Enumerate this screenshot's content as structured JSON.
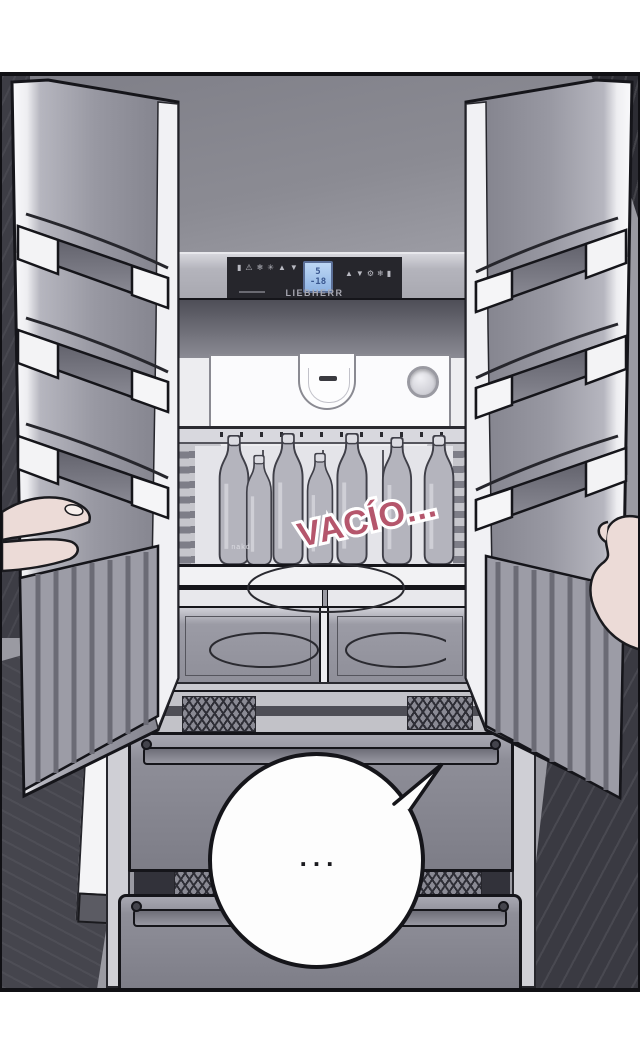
{
  "panel": {
    "sfx": {
      "text": "VACÍO...",
      "color": "#b5566c"
    },
    "speech_bubble": {
      "text": "..."
    },
    "fridge": {
      "brand": "LIEBHERR",
      "display": {
        "fridge_temp": "5",
        "freezer_temp": "-18"
      },
      "bottle_label": "nakd",
      "control_icons_left": [
        {
          "name": "power-icon",
          "glyph": "▮"
        },
        {
          "name": "alarm-icon",
          "glyph": "⚠"
        },
        {
          "name": "superfrost-icon",
          "glyph": "❄"
        },
        {
          "name": "ventilation-icon",
          "glyph": "✳"
        },
        {
          "name": "temp-up-icon",
          "glyph": "▲"
        },
        {
          "name": "temp-down-icon",
          "glyph": "▼"
        }
      ],
      "control_icons_right": [
        {
          "name": "temp-up-icon",
          "glyph": "▲"
        },
        {
          "name": "temp-down-icon",
          "glyph": "▼"
        },
        {
          "name": "settings-icon",
          "glyph": "⚙"
        },
        {
          "name": "frost-icon",
          "glyph": "❄"
        },
        {
          "name": "power-icon",
          "glyph": "▮"
        }
      ]
    },
    "colors": {
      "outline": "#15151a",
      "lcd_bg": "#a9c6ec",
      "lcd_text": "#3a578f",
      "skin": "#ecdbd7",
      "door_gray": "#9898a2",
      "sfx_pink": "#b5566c"
    }
  }
}
